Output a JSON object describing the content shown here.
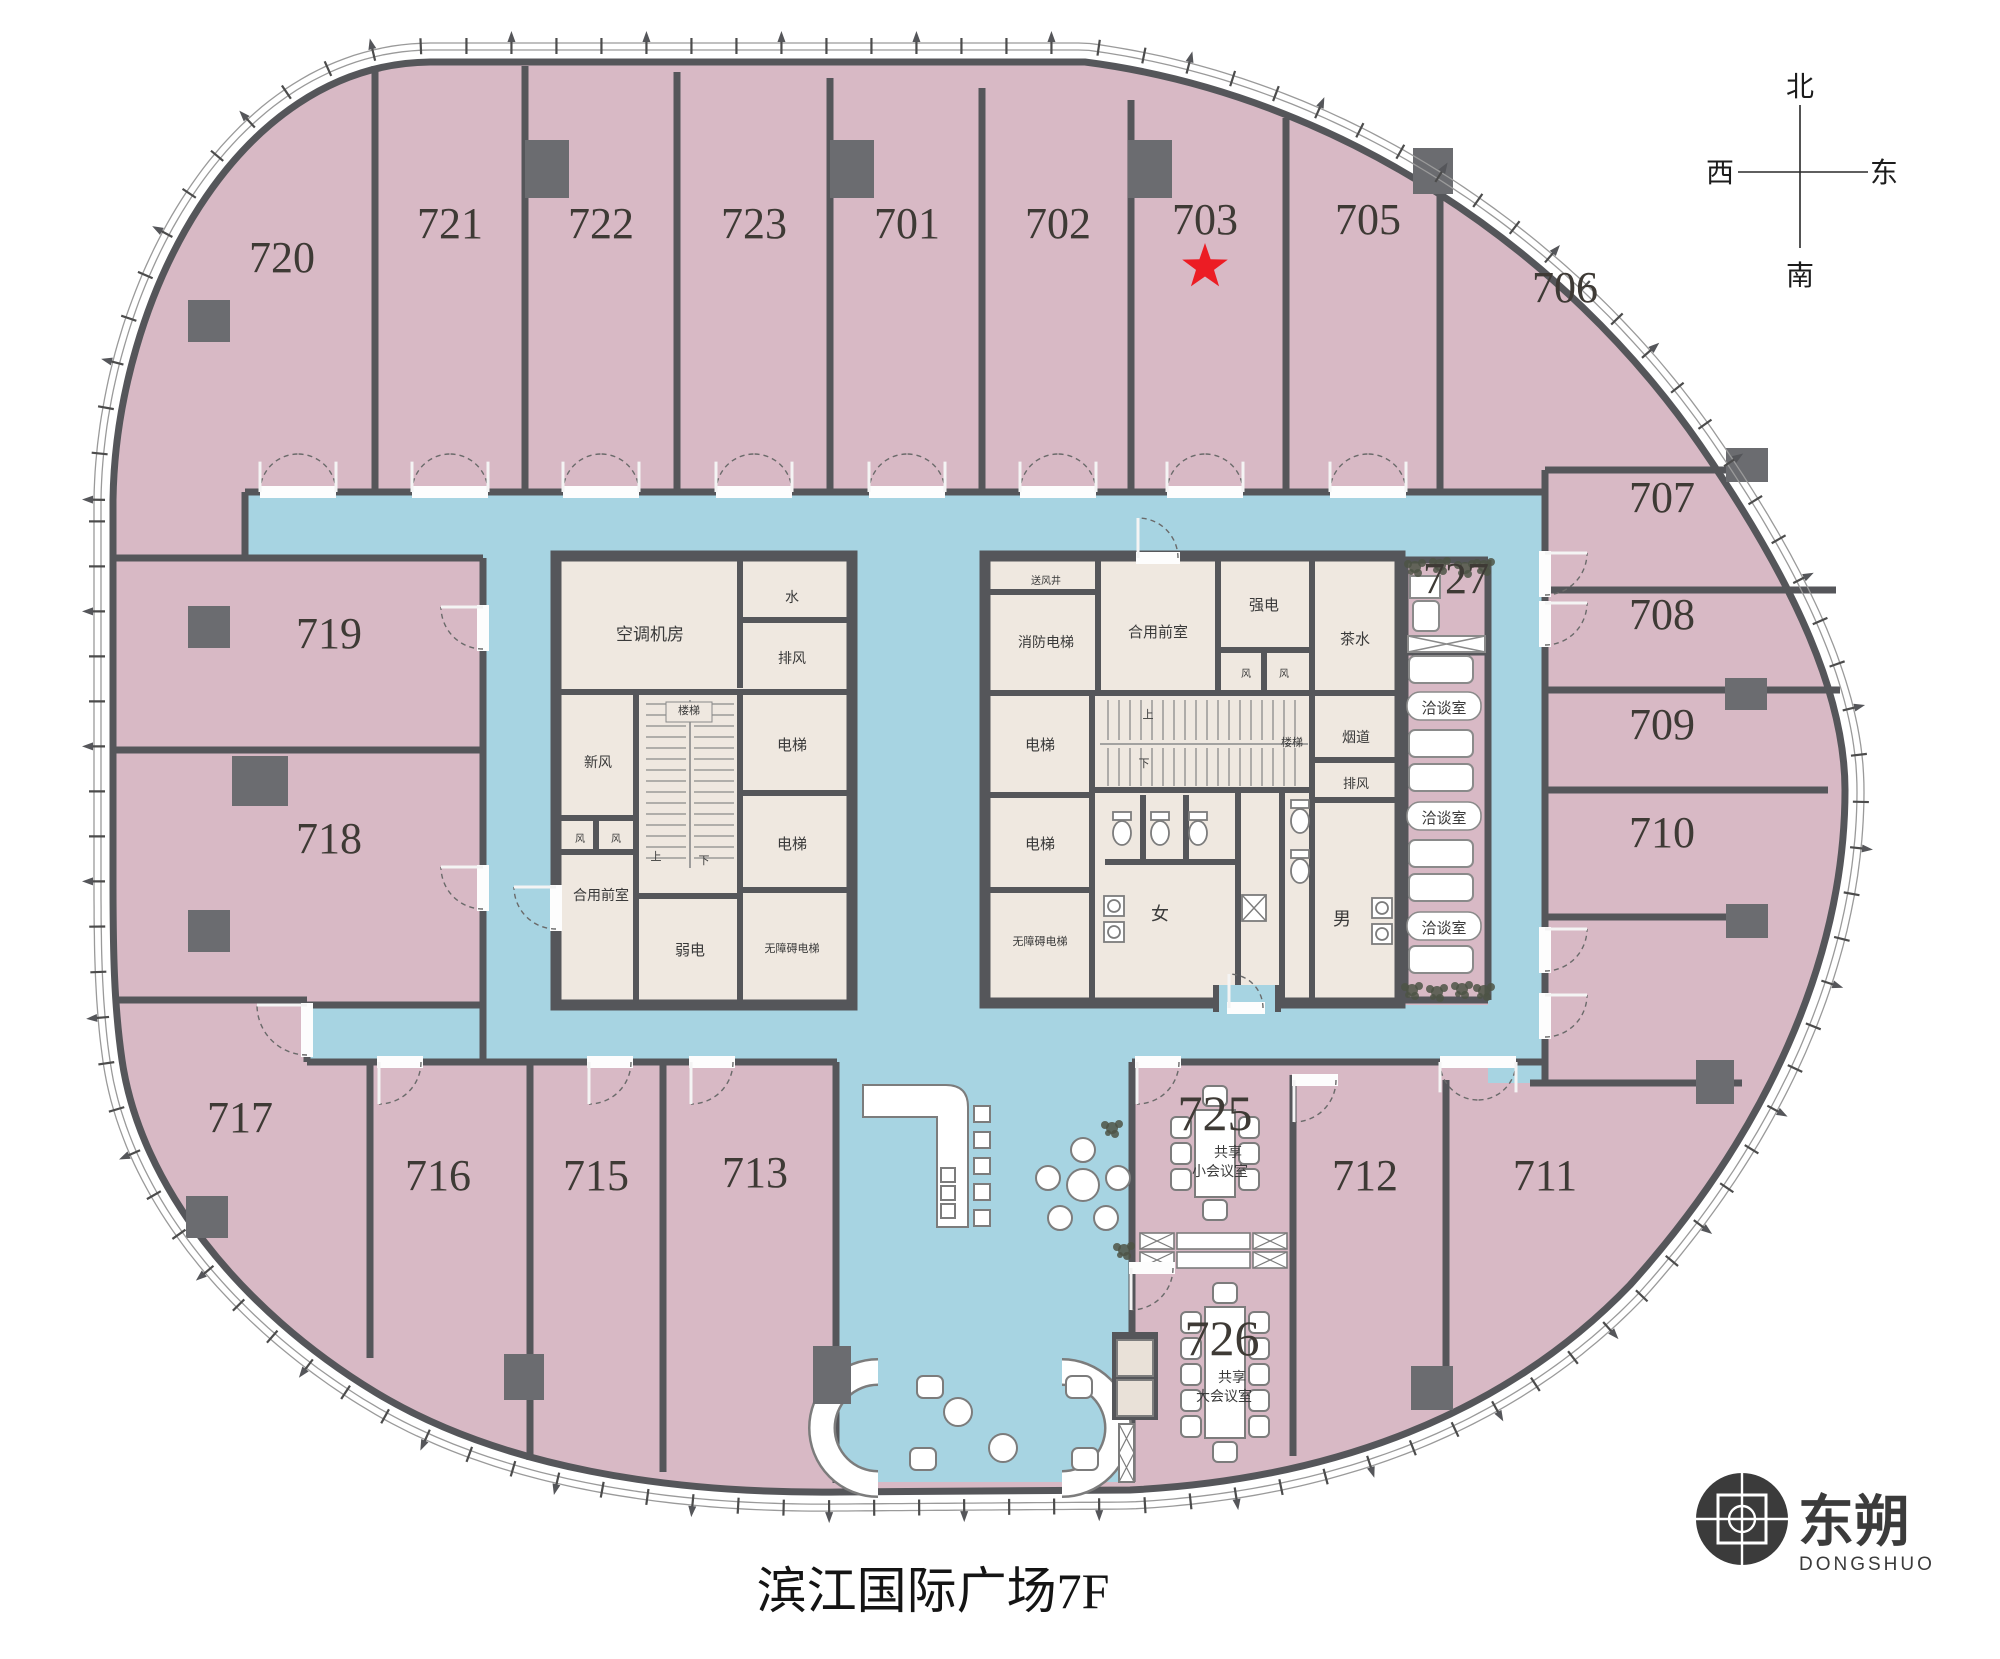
{
  "title": "滨江国际广场7F",
  "compass": {
    "north": "北",
    "south": "南",
    "east": "东",
    "west": "西"
  },
  "logo": {
    "cn": "东朔",
    "en": "DONGSHUO"
  },
  "marked_room": "703",
  "colors": {
    "room_pink": "#d8b9c5",
    "corridor_blue": "#a7d4e2",
    "core_beige": "#efe8e0",
    "wall_gray": "#55565a",
    "column_gray": "#6b6c70",
    "star_red": "#ec1c24"
  },
  "rooms": [
    {
      "number": "720",
      "x": 282,
      "y": 272
    },
    {
      "number": "721",
      "x": 450,
      "y": 238
    },
    {
      "number": "722",
      "x": 601,
      "y": 238
    },
    {
      "number": "723",
      "x": 754,
      "y": 238
    },
    {
      "number": "701",
      "x": 907,
      "y": 238
    },
    {
      "number": "702",
      "x": 1058,
      "y": 238
    },
    {
      "number": "703",
      "x": 1205,
      "y": 234,
      "starred": true
    },
    {
      "number": "705",
      "x": 1368,
      "y": 234
    },
    {
      "number": "706",
      "x": 1565,
      "y": 302
    },
    {
      "number": "707",
      "x": 1662,
      "y": 512
    },
    {
      "number": "708",
      "x": 1662,
      "y": 629
    },
    {
      "number": "709",
      "x": 1662,
      "y": 739
    },
    {
      "number": "710",
      "x": 1662,
      "y": 847
    },
    {
      "number": "711",
      "x": 1545,
      "y": 1190
    },
    {
      "number": "712",
      "x": 1365,
      "y": 1190
    },
    {
      "number": "713",
      "x": 755,
      "y": 1187
    },
    {
      "number": "715",
      "x": 596,
      "y": 1190
    },
    {
      "number": "716",
      "x": 438,
      "y": 1190
    },
    {
      "number": "717",
      "x": 240,
      "y": 1132
    },
    {
      "number": "718",
      "x": 329,
      "y": 853
    },
    {
      "number": "719",
      "x": 329,
      "y": 648
    },
    {
      "number": "725",
      "x": 1215,
      "y": 1130,
      "big": true
    },
    {
      "number": "726",
      "x": 1222,
      "y": 1355,
      "big": true
    },
    {
      "number": "727",
      "x": 1456,
      "y": 593
    }
  ],
  "meeting_rooms": {
    "small": {
      "number": "725",
      "line1": "共享",
      "line2": "小会议室"
    },
    "large": {
      "number": "726",
      "line1": "共享",
      "line2": "大会议室"
    },
    "booths": {
      "label": "洽谈室",
      "count": 3
    }
  },
  "core_left": {
    "rooms": [
      {
        "label": "空调机房",
        "x": 650,
        "y": 640,
        "fs": 17
      },
      {
        "label": "水",
        "x": 792,
        "y": 602,
        "fs": 14
      },
      {
        "label": "排风",
        "x": 792,
        "y": 663,
        "fs": 14
      },
      {
        "label": "电梯",
        "x": 792,
        "y": 750,
        "fs": 15
      },
      {
        "label": "电梯",
        "x": 792,
        "y": 849,
        "fs": 15
      },
      {
        "label": "无障碍电梯",
        "x": 792,
        "y": 952,
        "fs": 11
      },
      {
        "label": "新风",
        "x": 598,
        "y": 767,
        "fs": 14
      },
      {
        "label": "风",
        "x": 580,
        "y": 842,
        "fs": 10
      },
      {
        "label": "风",
        "x": 616,
        "y": 842,
        "fs": 10
      },
      {
        "label": "合用前室",
        "x": 601,
        "y": 900,
        "fs": 14
      },
      {
        "label": "楼梯",
        "x": 689,
        "y": 714,
        "fs": 11
      },
      {
        "label": "上",
        "x": 656,
        "y": 860,
        "fs": 11
      },
      {
        "label": "下",
        "x": 704,
        "y": 864,
        "fs": 11
      },
      {
        "label": "弱电",
        "x": 690,
        "y": 955,
        "fs": 15
      }
    ]
  },
  "core_right": {
    "rooms": [
      {
        "label": "送风井",
        "x": 1046,
        "y": 584,
        "fs": 10
      },
      {
        "label": "消防电梯",
        "x": 1046,
        "y": 647,
        "fs": 14
      },
      {
        "label": "合用前室",
        "x": 1158,
        "y": 637,
        "fs": 15
      },
      {
        "label": "强电",
        "x": 1264,
        "y": 610,
        "fs": 15
      },
      {
        "label": "风",
        "x": 1246,
        "y": 677,
        "fs": 10
      },
      {
        "label": "风",
        "x": 1284,
        "y": 677,
        "fs": 10
      },
      {
        "label": "茶水",
        "x": 1355,
        "y": 644,
        "fs": 15
      },
      {
        "label": "电梯",
        "x": 1040,
        "y": 750,
        "fs": 15
      },
      {
        "label": "电梯",
        "x": 1040,
        "y": 849,
        "fs": 15
      },
      {
        "label": "无障碍电梯",
        "x": 1040,
        "y": 945,
        "fs": 11
      },
      {
        "label": "楼梯",
        "x": 1292,
        "y": 746,
        "fs": 11
      },
      {
        "label": "上",
        "x": 1148,
        "y": 718,
        "fs": 11
      },
      {
        "label": "下",
        "x": 1144,
        "y": 767,
        "fs": 11
      },
      {
        "label": "烟道",
        "x": 1356,
        "y": 742,
        "fs": 14
      },
      {
        "label": "排风",
        "x": 1356,
        "y": 788,
        "fs": 13
      },
      {
        "label": "女",
        "x": 1160,
        "y": 920,
        "fs": 18
      },
      {
        "label": "男",
        "x": 1342,
        "y": 925,
        "fs": 18
      }
    ]
  },
  "stairs": {
    "up": "上",
    "down": "下",
    "label": "楼梯"
  }
}
